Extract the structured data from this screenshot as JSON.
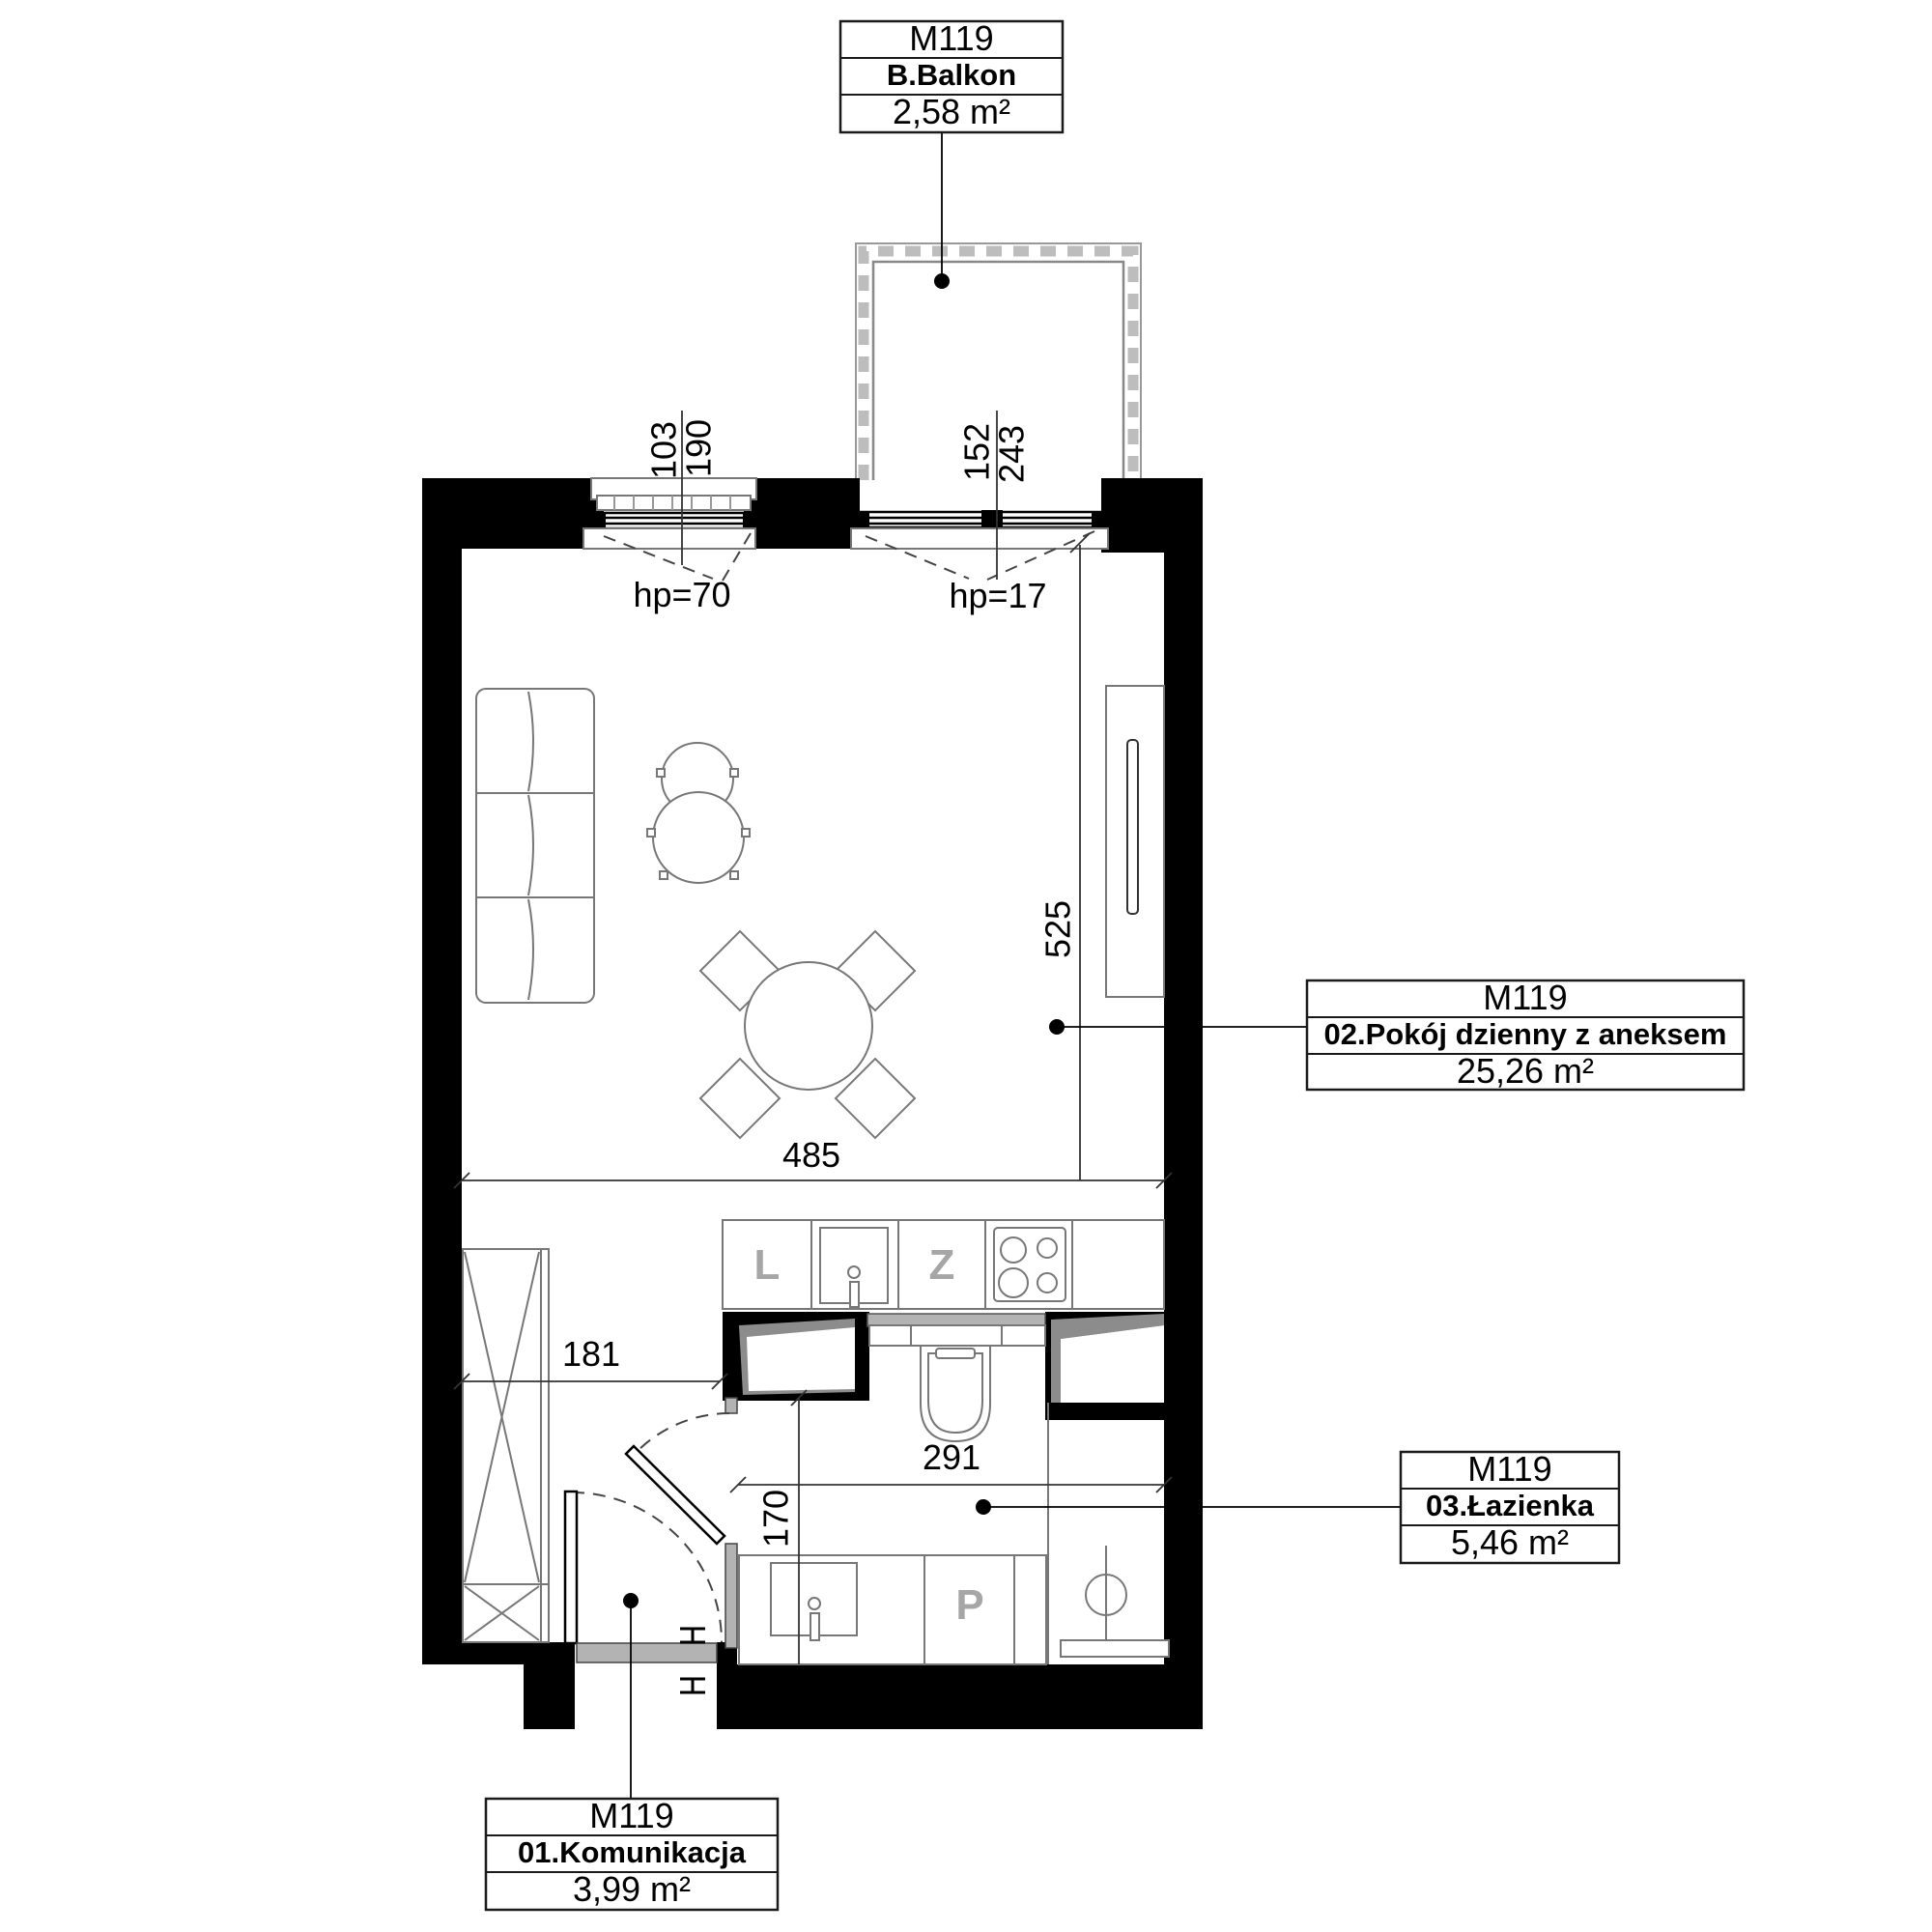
{
  "labels": {
    "balkon": {
      "unit": "M119",
      "room": "B.Balkon",
      "area": "2,58 m²"
    },
    "living": {
      "unit": "M119",
      "room": "02.Pokój dzienny z aneksem",
      "area": "25,26 m²"
    },
    "bathroom": {
      "unit": "M119",
      "room": "03.Łazienka",
      "area": "5,46 m²"
    },
    "hallway": {
      "unit": "M119",
      "room": "01.Komunikacja",
      "area": "3,99 m²"
    }
  },
  "dimensions": {
    "living_window_width": "103",
    "living_window_height": "190",
    "living_window_hp": "hp=70",
    "balcony_door_width": "152",
    "balcony_door_height": "243",
    "balcony_door_hp": "hp=17",
    "living_room_depth": "525",
    "living_room_width": "485",
    "hallway_width": "181",
    "bathroom_width": "291",
    "bathroom_depth": "170"
  },
  "appliances": {
    "fridge_letter": "L",
    "dishwasher_letter": "Z",
    "washer_letter": "P"
  },
  "colors": {
    "wall": "#000000",
    "furniture_line": "#777777",
    "threshold_gray": "#b3b3b3"
  }
}
